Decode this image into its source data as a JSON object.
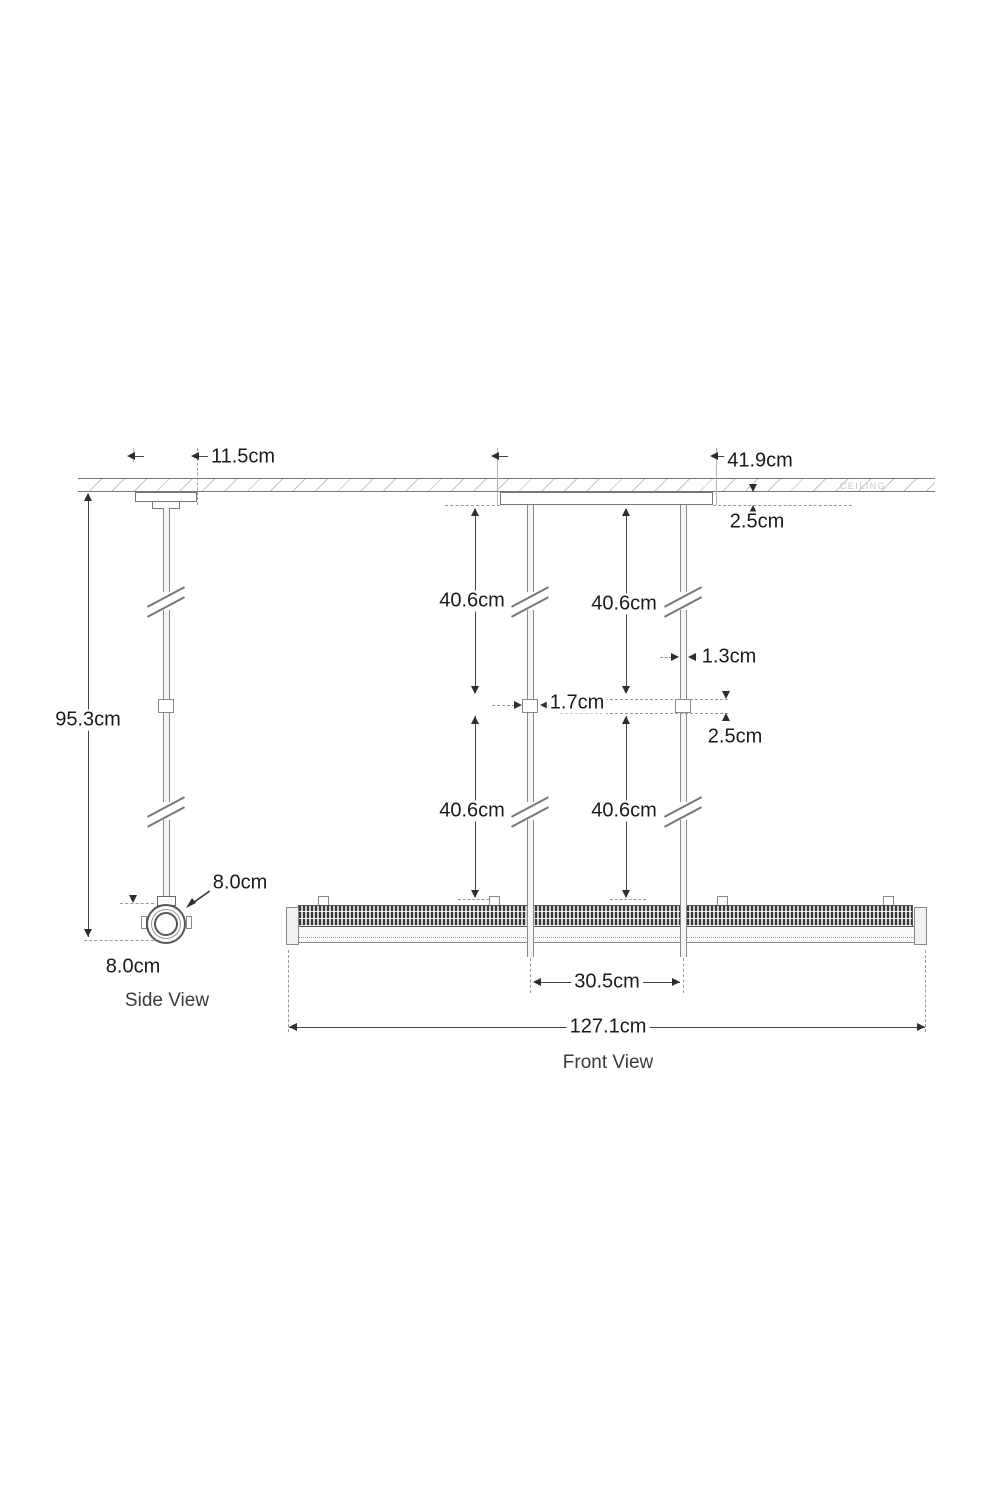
{
  "views": {
    "side_label": "Side View",
    "front_label": "Front View"
  },
  "ceiling": {
    "label": "CEILING"
  },
  "dims": {
    "side_canopy_width": "11.5cm",
    "overall_drop": "95.3cm",
    "fixture_diameter": "8.0cm",
    "fixture_height": "8.0cm",
    "front_canopy_width": "41.9cm",
    "canopy_height": "2.5cm",
    "upper_left_drop": "40.6cm",
    "upper_right_drop": "40.6cm",
    "lower_left_drop": "40.6cm",
    "lower_right_drop": "40.6cm",
    "stem_diameter": "1.3cm",
    "connector_width": "1.7cm",
    "connector_height": "2.5cm",
    "stem_spacing": "30.5cm",
    "fixture_length": "127.1cm"
  },
  "colors": {
    "line": "#777777",
    "dimension_line": "#444444",
    "text": "#1a1a1a",
    "background": "#ffffff"
  }
}
